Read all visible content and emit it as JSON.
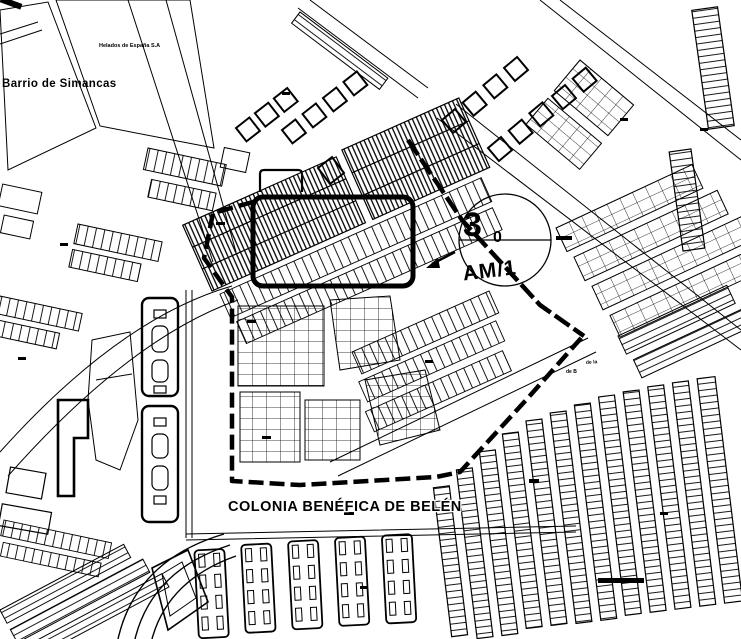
{
  "map": {
    "type": "cadastral-plan",
    "labels": {
      "district": "Barrio de Simancas",
      "factory": "Helados de España S.A",
      "colonia": "COLONIA BENÉFICA DE BELÉN",
      "micro_1": "de la",
      "micro_2": "de B"
    },
    "marker": {
      "number": "3",
      "sub": "0",
      "code": "AM/1"
    },
    "colors": {
      "ink": "#000000",
      "paper": "#ffffff"
    }
  }
}
